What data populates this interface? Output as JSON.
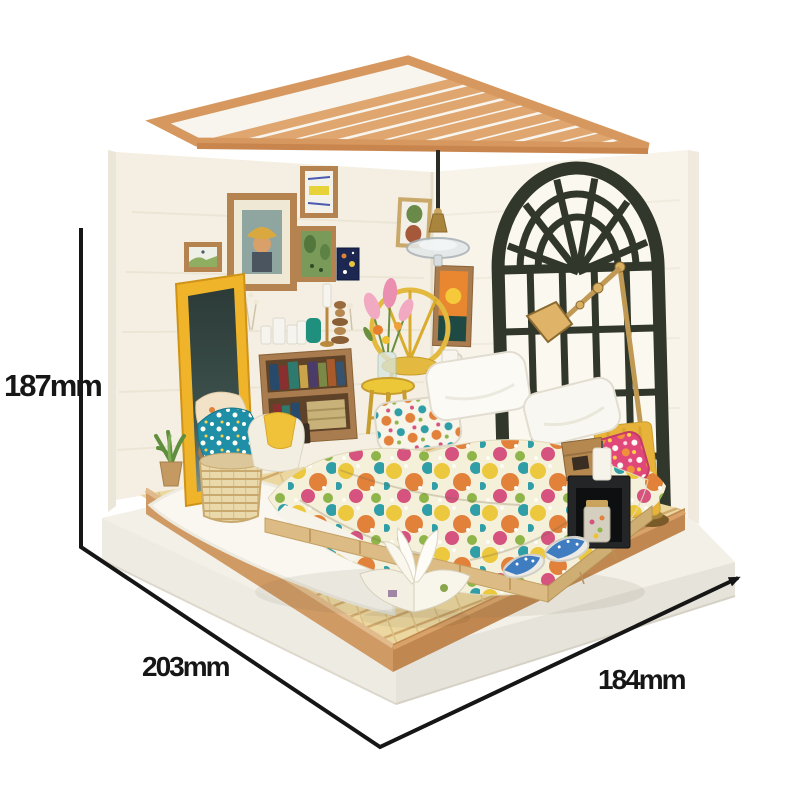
{
  "meta": {
    "description": "Product photo of a DIY miniature dollhouse bedroom diorama kit shown on a white background with printed outer dimensions",
    "background_color": "#ffffff"
  },
  "annotations": {
    "height": "187mm",
    "width": "203mm",
    "depth": "184mm",
    "line_color": "#161616",
    "text_color": "#161616"
  },
  "scene": {
    "objects": [
      "slatted-wood-roof",
      "pendant-lamp",
      "arched-window",
      "gallery-wall-frames",
      "standing-mirror",
      "draped-cloths",
      "wicker-basket",
      "potted-succulent",
      "bookshelf-with-books",
      "candles",
      "brass-candlestick",
      "flower-stool",
      "rattan-chair",
      "leaning-sunset-picture",
      "double-bed",
      "floral-duvet",
      "white-pillows",
      "floral-pillows",
      "yellow-headboard",
      "wooden-crate",
      "black-nightstand",
      "candy-jar",
      "brass-floor-lamp",
      "blue-slippers",
      "open-picture-book",
      "white-fluffy-rug",
      "plank-floor",
      "wood-trim-platform",
      "white-display-base"
    ],
    "palette": {
      "roof_wood": "#dfa670",
      "wall_white": "#f4efe2",
      "window_frame": "#31372a",
      "floor_wood": "#ecd7a0",
      "platform_trim": "#d09a64",
      "base_white": "#f1eee6",
      "mirror_frame_yellow": "#f0b42a",
      "brass": "#b98a3e",
      "bedding_cream": "#f5f0da",
      "teal": "#1f8fa8",
      "pink": "#e0487a",
      "orange": "#e2813a",
      "yellow": "#ecc83e",
      "slipper_blue": "#3f7cc0"
    }
  }
}
